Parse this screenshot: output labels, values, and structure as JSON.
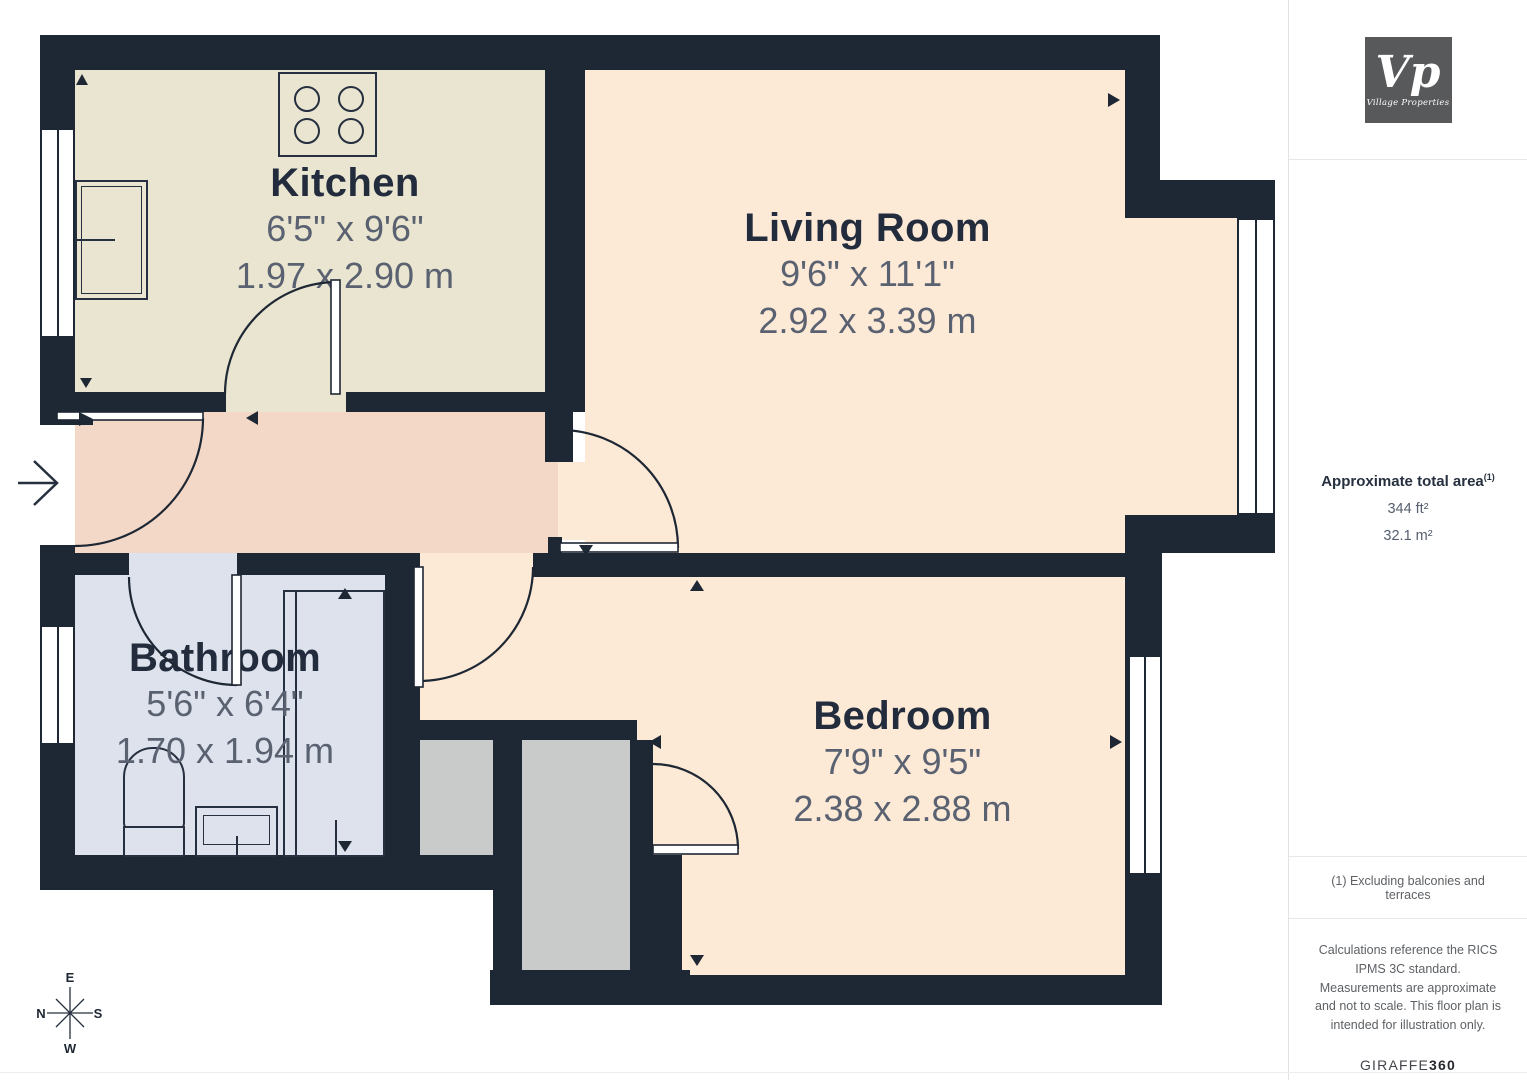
{
  "floorplan": {
    "rooms": [
      {
        "name": "Kitchen",
        "imperial": "6'5\" x 9'6\"",
        "metric": "1.97 x 2.90 m"
      },
      {
        "name": "Living Room",
        "imperial": "9'6\" x 11'1\"",
        "metric": "2.92 x 3.39 m"
      },
      {
        "name": "Bathroom",
        "imperial": "5'6\" x 6'4\"",
        "metric": "1.70 x 1.94 m"
      },
      {
        "name": "Bedroom",
        "imperial": "7'9\" x 9'5\"",
        "metric": "2.38 x 2.88 m"
      }
    ],
    "compass": {
      "top": "E",
      "left": "N",
      "right": "S",
      "bottom": "W"
    }
  },
  "sidebar": {
    "logo": {
      "monogram": "Vp",
      "name": "Village Properties"
    },
    "area": {
      "label": "Approximate total area",
      "footnote_marker": "(1)",
      "imperial": "344 ft²",
      "metric": "32.1 m²"
    },
    "footnote": "(1) Excluding balconies and terraces",
    "disclaimer": "Calculations reference the RICS IPMS 3C standard. Measurements are approximate and not to scale. This floor plan is intended for illustration only.",
    "provider": {
      "name": "GIRAFFE",
      "suffix": "360"
    }
  },
  "colors": {
    "wall": "#1e2734",
    "kitchen_floor": "#eae5d0",
    "living_floor": "#fce9d6",
    "hall_floor": "#f3d8c8",
    "bathroom_floor": "#dee2ed",
    "storage": "#c9cbca",
    "title_text": "#232c3d",
    "dimension_text": "#5a6271",
    "logo_bg": "#58595b"
  }
}
